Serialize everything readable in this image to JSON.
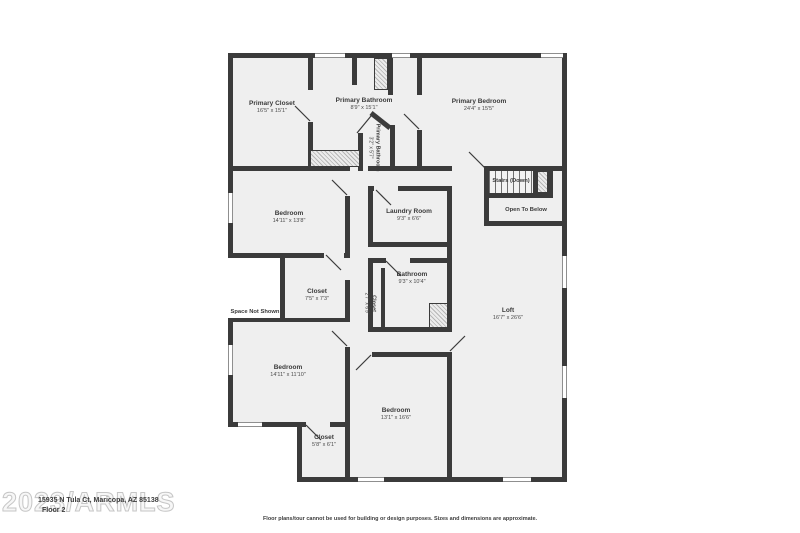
{
  "meta": {
    "watermark": "2023/ARMLS",
    "address": "15935 N Tula Ct, Maricopa, AZ 85138",
    "floor_label": "Floor 2",
    "disclaimer": "Floor plans/tour cannot be used for building or design purposes. Sizes and dimensions are approximate."
  },
  "rooms": {
    "primary_closet": {
      "name": "Primary Closet",
      "dims": "16'5\" x 15'1\""
    },
    "primary_bathroom": {
      "name": "Primary Bathroom",
      "dims": "8'9\" x 15'1\""
    },
    "primary_bathroom_small": {
      "name": "Primary Bathroom",
      "dims": "3'2\" x 5'7\""
    },
    "primary_bedroom": {
      "name": "Primary Bedroom",
      "dims": "24'4\" x 15'5\""
    },
    "bedroom_mid": {
      "name": "Bedroom",
      "dims": "14'11\" x 13'8\""
    },
    "laundry_room": {
      "name": "Laundry Room",
      "dims": "9'3\" x 6'6\""
    },
    "stairs": {
      "name": "Stairs (Down)"
    },
    "open_to_below": {
      "name": "Open To Below"
    },
    "closet_mid": {
      "name": "Closet",
      "dims": "7'5\" x 7'3\""
    },
    "space_not_shown": {
      "name": "Space Not Shown"
    },
    "closet_small": {
      "name": "Closet",
      "dims": "2'7\" x 6'9\""
    },
    "bathroom": {
      "name": "Bathroom",
      "dims": "9'3\" x 10'4\""
    },
    "loft": {
      "name": "Loft",
      "dims": "16'7\" x 26'6\""
    },
    "bedroom_bottom_left": {
      "name": "Bedroom",
      "dims": "14'11\" x 11'10\""
    },
    "bedroom_bottom": {
      "name": "Bedroom",
      "dims": "13'1\" x 16'6\""
    },
    "closet_bottom": {
      "name": "Closet",
      "dims": "5'8\" x 6'1\""
    }
  },
  "colors": {
    "wall": "#3b3b3b",
    "floor": "#efefef",
    "hatch_line": "#b5b5b5",
    "text": "#3d3d3d",
    "watermark_outline": "#c6c6c6"
  }
}
